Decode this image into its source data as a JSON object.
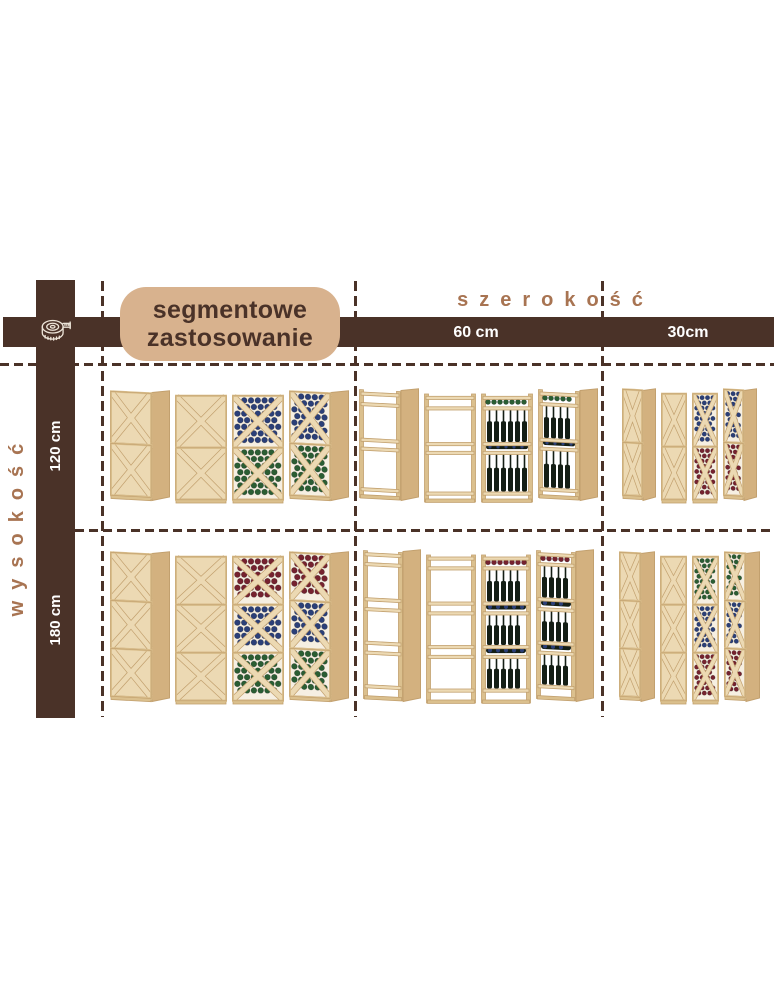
{
  "title_badge": {
    "line1": "segmentowe",
    "line2": "zastosowanie"
  },
  "axes": {
    "width": {
      "label": "szerokość",
      "columns": [
        {
          "label": "60 cm"
        },
        {
          "label": "30cm"
        }
      ]
    },
    "height": {
      "label": "wysokość",
      "rows": [
        {
          "label": "120 cm"
        },
        {
          "label": "180 cm"
        }
      ]
    }
  },
  "icons": {
    "tape_measure": "tape-measure-icon"
  },
  "colors": {
    "dark_brown": "#4a3228",
    "tan_badge": "#d8b28e",
    "light_brown_text": "#a87452",
    "white_text": "#ffffff",
    "wood_face": "#ecd9b3",
    "wood_mid": "#dbc08e",
    "wood_edge": "#c2a06e",
    "wood_side": "#d3b17f",
    "bottle_dark": "#141e15",
    "bottle_blue": "#2b3f78",
    "bottle_green": "#2a5d33",
    "bottle_red": "#75222f"
  },
  "matrix": {
    "cells": [
      {
        "id": "h120-segment",
        "row": "120 cm",
        "column": "segmentowe zastosowanie",
        "rack": {
          "type": "x-cube",
          "units": 2,
          "narrow": false,
          "bottle_colors": [
            "#2b3f78",
            "#2a5d33"
          ]
        },
        "racks": [
          {
            "view": "angled",
            "filled": false
          },
          {
            "view": "front",
            "filled": false
          },
          {
            "view": "front",
            "filled": true
          },
          {
            "view": "angled",
            "filled": true
          }
        ]
      },
      {
        "id": "h120-w60",
        "row": "120 cm",
        "column": "60 cm",
        "rack": {
          "type": "shelf",
          "units": 2,
          "cap_color": "#2a5d33",
          "lying_color": "#2b3f78"
        },
        "racks": [
          {
            "view": "angled",
            "filled": false
          },
          {
            "view": "front",
            "filled": false
          },
          {
            "view": "front",
            "filled": true
          },
          {
            "view": "angled",
            "filled": true
          }
        ]
      },
      {
        "id": "h120-w30",
        "row": "120 cm",
        "column": "30cm",
        "rack": {
          "type": "x-cube",
          "units": 2,
          "narrow": true,
          "bottle_colors": [
            "#2b3f78",
            "#75222f"
          ]
        },
        "racks": [
          {
            "view": "angled",
            "filled": false
          },
          {
            "view": "front",
            "filled": false
          },
          {
            "view": "front",
            "filled": true
          },
          {
            "view": "angled",
            "filled": true
          }
        ]
      },
      {
        "id": "h180-segment",
        "row": "180 cm",
        "column": "segmentowe zastosowanie",
        "rack": {
          "type": "x-cube",
          "units": 3,
          "narrow": false,
          "bottle_colors": [
            "#75222f",
            "#2b3f78",
            "#2a5d33"
          ]
        },
        "racks": [
          {
            "view": "angled",
            "filled": false
          },
          {
            "view": "front",
            "filled": false
          },
          {
            "view": "front",
            "filled": true
          },
          {
            "view": "angled",
            "filled": true
          }
        ]
      },
      {
        "id": "h180-w60",
        "row": "180 cm",
        "column": "60 cm",
        "rack": {
          "type": "shelf",
          "units": 3,
          "cap_color": "#75222f",
          "lying_color": "#2b3f78"
        },
        "racks": [
          {
            "view": "angled",
            "filled": false
          },
          {
            "view": "front",
            "filled": false
          },
          {
            "view": "front",
            "filled": true
          },
          {
            "view": "angled",
            "filled": true
          }
        ]
      },
      {
        "id": "h180-w30",
        "row": "180 cm",
        "column": "30cm",
        "rack": {
          "type": "x-cube",
          "units": 3,
          "narrow": true,
          "bottle_colors": [
            "#2a5d33",
            "#2b3f78",
            "#75222f"
          ]
        },
        "racks": [
          {
            "view": "angled",
            "filled": false
          },
          {
            "view": "front",
            "filled": false
          },
          {
            "view": "front",
            "filled": true
          },
          {
            "view": "angled",
            "filled": true
          }
        ]
      }
    ]
  }
}
